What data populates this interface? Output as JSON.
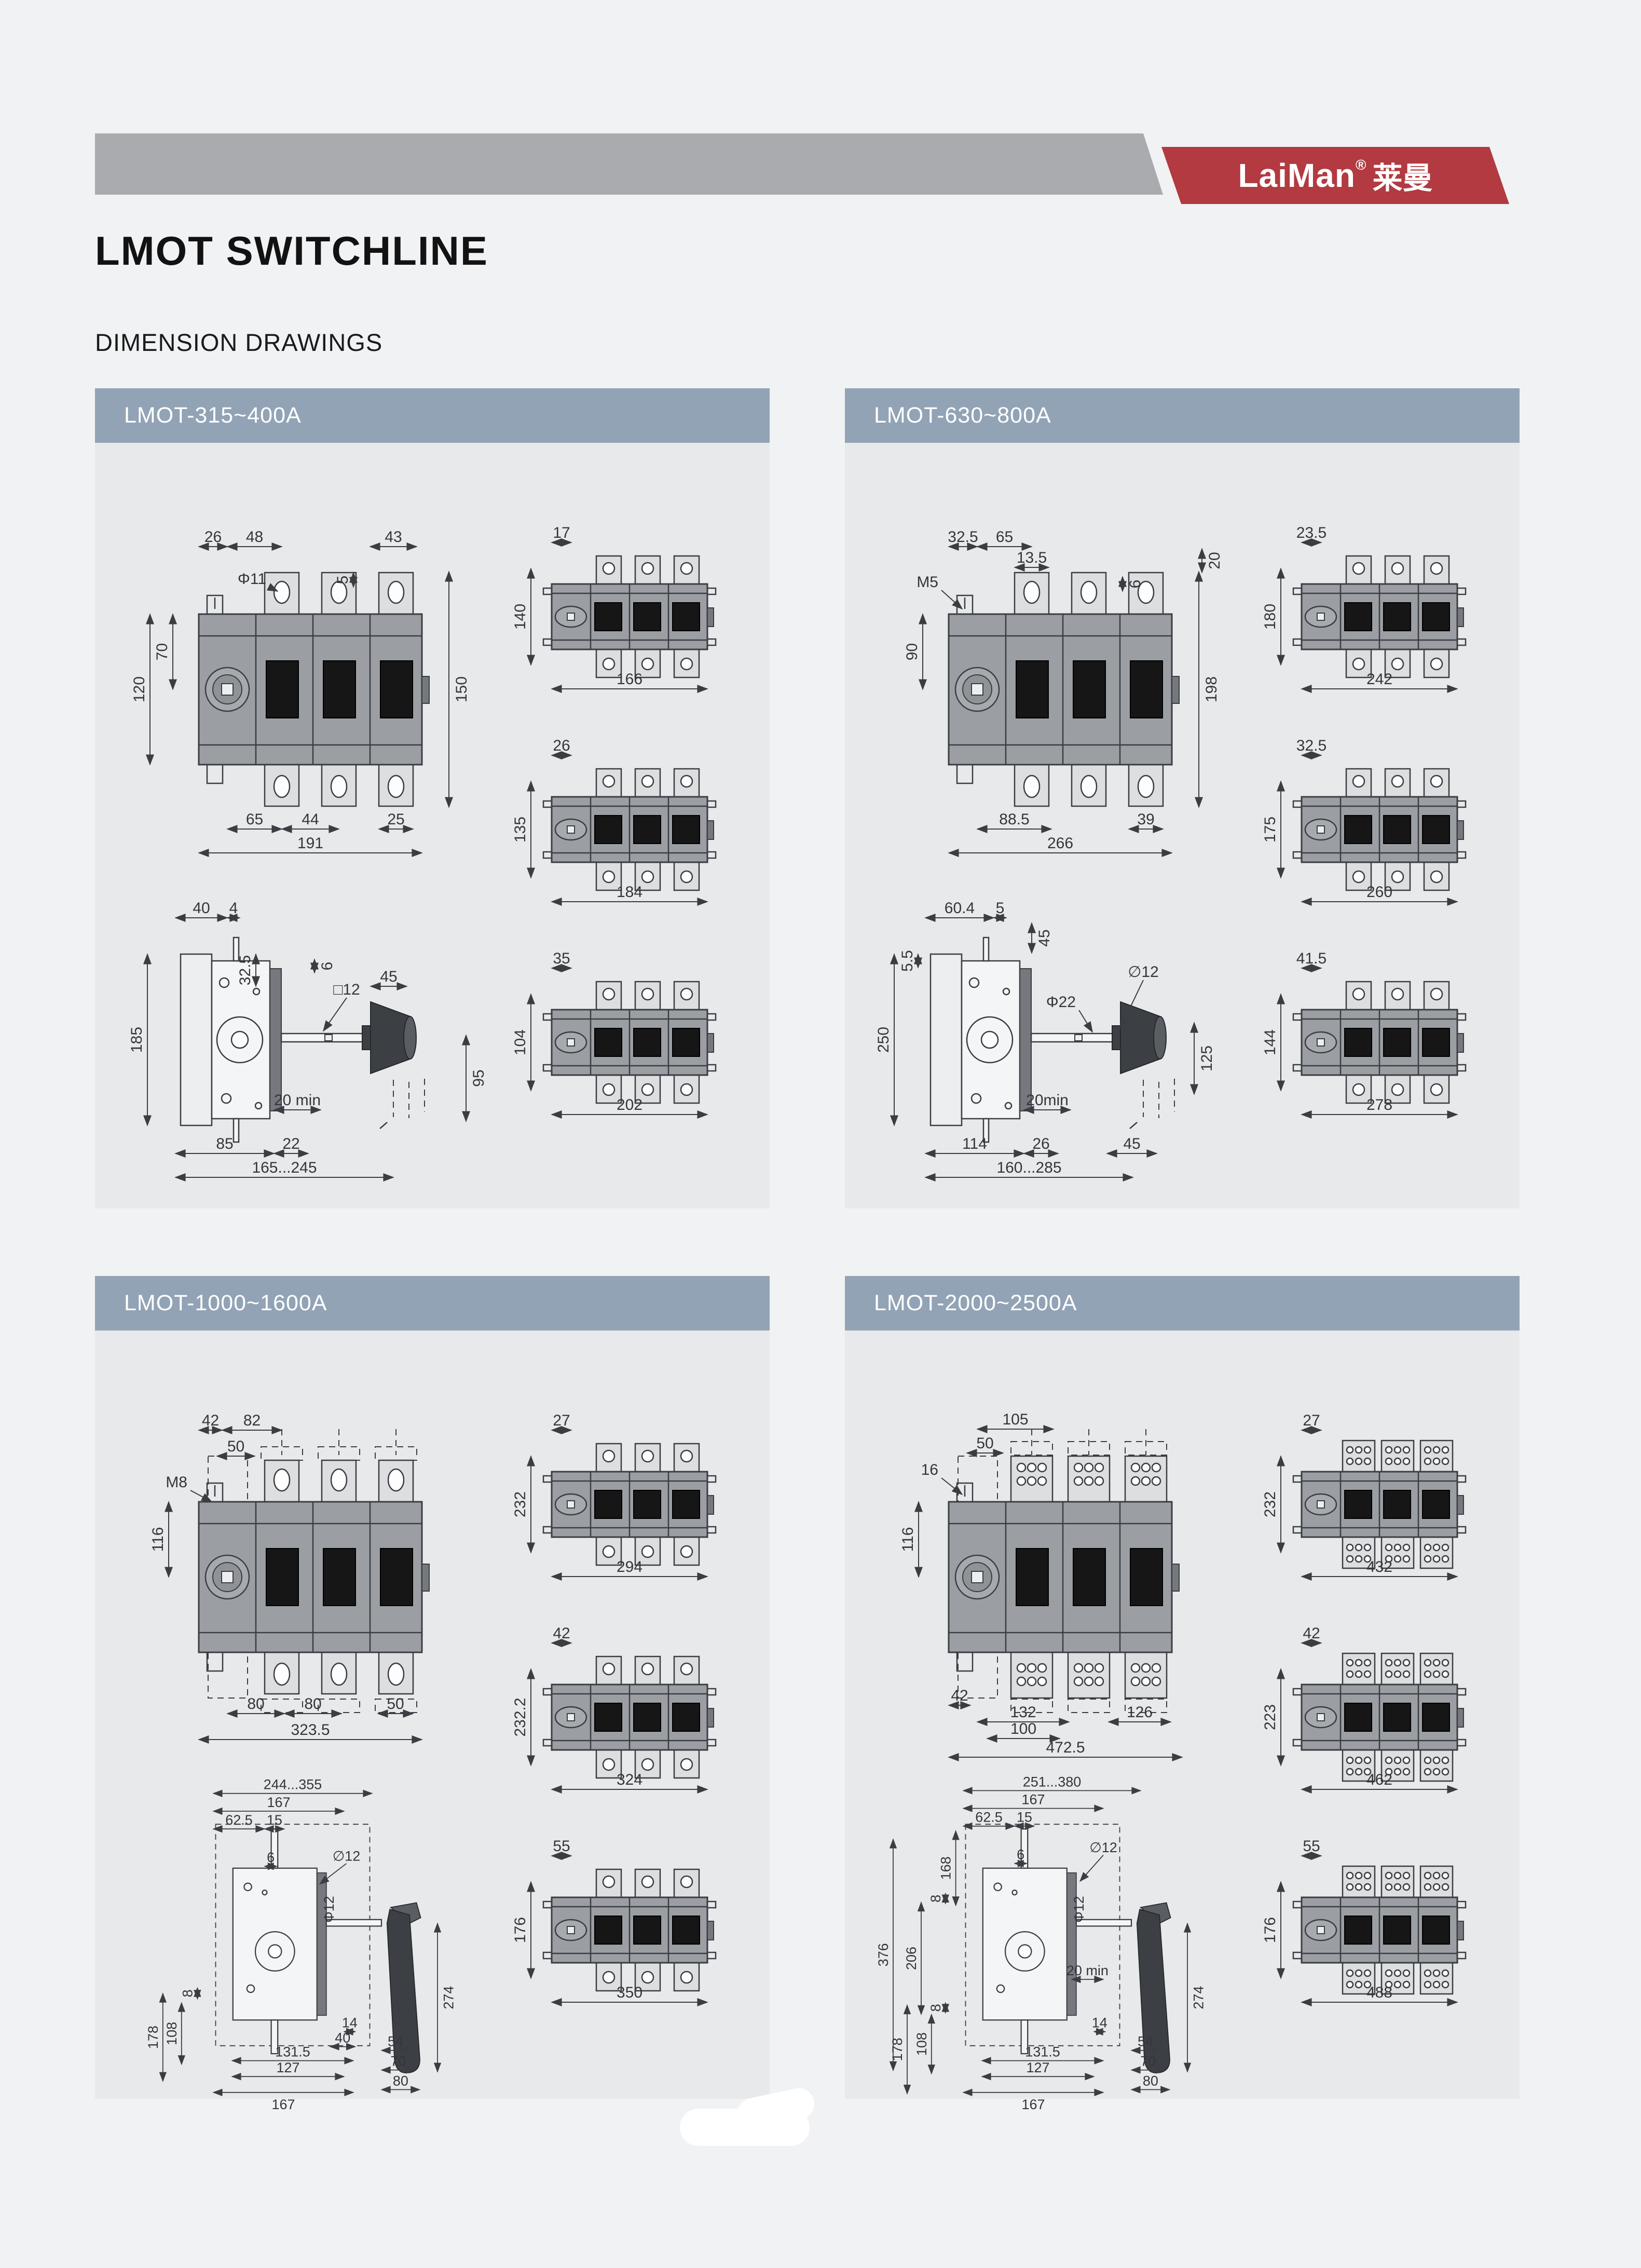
{
  "header": {
    "brand": "LaiMan",
    "reg": "®",
    "brand_cn": "莱曼"
  },
  "title": "LMOT SWITCHLINE",
  "subtitle": "DIMENSION DRAWINGS",
  "colors": {
    "page_bg": "#f1f2f4",
    "gray_bar": "#a9abae",
    "brand_red": "#b23a40",
    "panel_header": "#92a3b6",
    "panel_bg": "#e8e9eb",
    "line": "#3a3d42"
  },
  "panels": [
    {
      "title": "LMOT-315~400A",
      "front": {
        "d1": "26",
        "d2": "48",
        "d3": "43",
        "hole": "Φ11",
        "d5": "5",
        "v1": "70",
        "v2": "120",
        "v3": "150",
        "b1": "65",
        "b2": "44",
        "b3": "25",
        "b4": "191"
      },
      "side": {
        "t1": "40",
        "t2": "4",
        "r1": "32.5",
        "r2": "6",
        "sq": "□12",
        "t3": "45",
        "v1": "185",
        "min": "20 min",
        "v2": "95",
        "b1": "85",
        "b2": "22",
        "b3": "165...245"
      },
      "tops": [
        {
          "t": "17",
          "v": "140",
          "b": "166"
        },
        {
          "t": "26",
          "v": "135",
          "b": "184"
        },
        {
          "t": "35",
          "v": "104",
          "b": "202"
        }
      ]
    },
    {
      "title": "LMOT-630~800A",
      "front": {
        "d1": "32.5",
        "d2": "65",
        "m": "M5",
        "d3": "13.5",
        "d4": "6",
        "d5": "20",
        "v1": "90",
        "v2": "198",
        "b1": "88.5",
        "b2": "39",
        "b3": "266"
      },
      "side": {
        "t1": "60.4",
        "t2": "5",
        "r1": "5.5",
        "r2": "45",
        "v1": "250",
        "phi": "Φ22",
        "sq": "∅12",
        "v2": "125",
        "min": "20min",
        "b1": "114",
        "b2": "26",
        "b3": "45",
        "b4": "160...285"
      },
      "tops": [
        {
          "t": "23.5",
          "v": "180",
          "b": "242"
        },
        {
          "t": "32.5",
          "v": "175",
          "b": "260"
        },
        {
          "t": "41.5",
          "v": "144",
          "b": "278"
        }
      ]
    },
    {
      "title": "LMOT-1000~1600A",
      "front": {
        "d1": "42",
        "d2": "82",
        "d3": "50",
        "m": "M8",
        "v1": "116",
        "b1": "80",
        "b2": "80",
        "b3": "50",
        "b4": "323.5"
      },
      "side": {
        "t1": "244...355",
        "t2": "167",
        "t3": "62.5",
        "t4": "15",
        "t5": "6",
        "sq": "∅12",
        "phi": "Φ12",
        "l1": "8",
        "l2": "178",
        "l3": "108",
        "r1": "14",
        "r2": "40",
        "r3": "274",
        "r4": "54",
        "r5": "70",
        "r6": "80",
        "b1": "131.5",
        "b2": "127",
        "b3": "167"
      },
      "tops": [
        {
          "t": "27",
          "v": "232",
          "b": "294"
        },
        {
          "t": "42",
          "v": "232.2",
          "b": "324"
        },
        {
          "t": "55",
          "v": "176",
          "b": "350"
        }
      ]
    },
    {
      "title": "LMOT-2000~2500A",
      "front": {
        "d1": "105",
        "d2": "50",
        "d3": "16",
        "v1": "116",
        "b1": "42",
        "b2": "132",
        "b3": "100",
        "b4": "126",
        "b5": "472.5"
      },
      "side": {
        "t1": "251...380",
        "t2": "167",
        "t3": "62.5",
        "t4": "15",
        "t5": "168",
        "t6": "6",
        "sq": "∅12",
        "phi": "Φ12",
        "l1": "376",
        "l2": "206",
        "l3": "8",
        "l4": "8",
        "l5": "178",
        "l6": "108",
        "min": "20 min",
        "r0": "14",
        "r1": "274",
        "r2": "54",
        "r3": "70",
        "r4": "80",
        "b1": "131.5",
        "b2": "127",
        "b3": "167"
      },
      "tops": [
        {
          "t": "27",
          "v": "232",
          "b": "432"
        },
        {
          "t": "42",
          "v": "223",
          "b": "462"
        },
        {
          "t": "55",
          "v": "176",
          "b": "488"
        }
      ]
    }
  ]
}
